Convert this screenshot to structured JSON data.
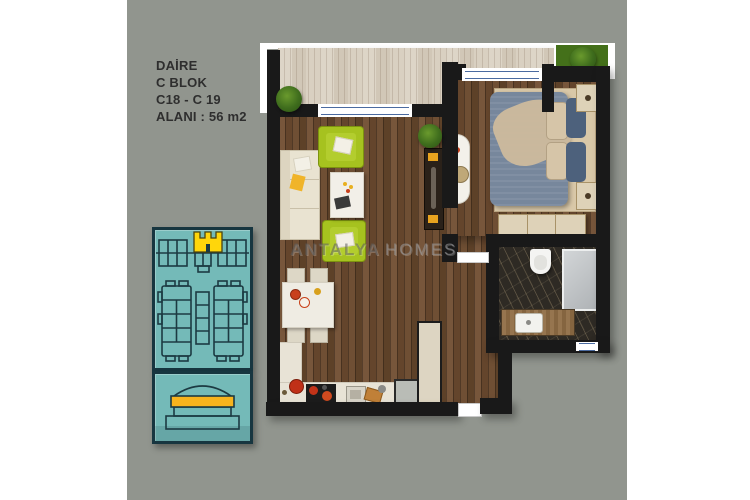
{
  "listing": {
    "type_label": "DAİRE",
    "block_label": "C BLOK",
    "units_label": "C18 - C 19",
    "area_label": "ALANI : 56 m2"
  },
  "watermark": {
    "primary": "ANTALYA",
    "secondary": "HOMES"
  },
  "floor_plan": {
    "rooms": [
      "terrace",
      "living-room",
      "kitchen",
      "hallway",
      "bedroom",
      "bathroom"
    ],
    "outdoor": [
      "garden-grass"
    ],
    "side_panels": [
      "block-site-plan-with-highlighted-unit",
      "building-elevation-with-highlighted-floor"
    ]
  },
  "palette": {
    "canvas_white": "#ffffff",
    "background_gray": "#91958e",
    "wall_black": "#191919",
    "dark_wood_floor": "#6b4c30",
    "terrace_light_wood": "#d8cfc0",
    "teal_panel": "#74bab8",
    "panel_outline_navy": "#1c3a42",
    "unit_highlight_yellow": "#ffd60b",
    "floor_highlight_orange": "#f8b41d",
    "sofa_cream": "#e9e3d1",
    "armchair_green": "#a6c21f",
    "bed_blue": "#77879c",
    "bathroom_marble": "#2e2a24",
    "grass_green": "#4e7d1e",
    "window_frame_blue": "#4a6aa0",
    "text_dark": "#2e2e2e"
  }
}
